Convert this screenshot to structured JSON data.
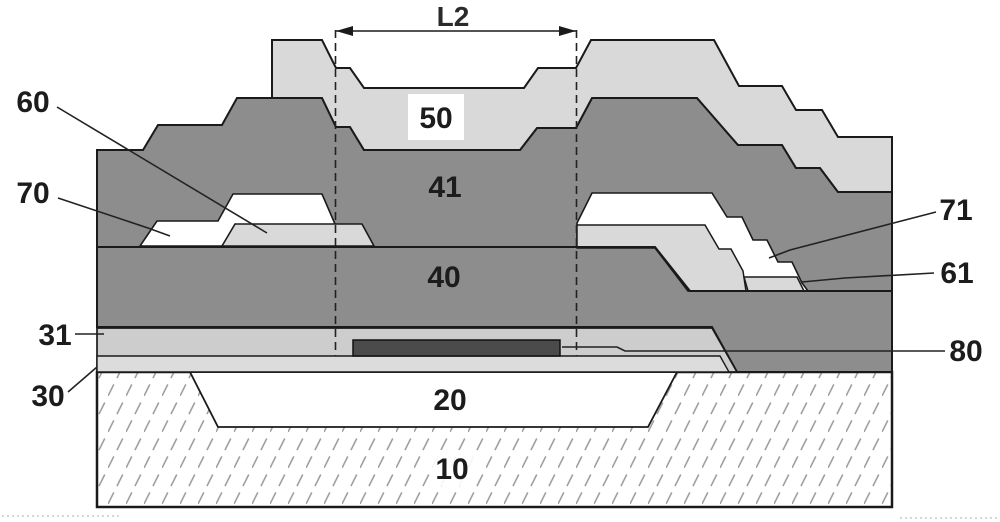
{
  "figure": {
    "type": "patent cross-section diagram of layered thin-film device",
    "dimension": {
      "label": "L2"
    },
    "labels": {
      "l2": {
        "text": "L2"
      },
      "n10": {
        "text": "10"
      },
      "n20": {
        "text": "20"
      },
      "n30": {
        "text": "30"
      },
      "n31": {
        "text": "31"
      },
      "n40": {
        "text": "40"
      },
      "n41": {
        "text": "41"
      },
      "n50": {
        "text": "50"
      },
      "n60": {
        "text": "60"
      },
      "n61": {
        "text": "61"
      },
      "n70": {
        "text": "70"
      },
      "n71": {
        "text": "71"
      },
      "n80": {
        "text": "80"
      }
    },
    "colors": {
      "background": "#ffffff",
      "layer_dark_gray": "#8d8d8d",
      "layer_light_gray": "#d9d9d9",
      "layer_31_gray": "#cdcdcd",
      "layer_30_gray": "#dcdcdc",
      "bar_dark": "#4b4b4b",
      "outline": "#1a1a1a",
      "hatch_line": "#a0a0a0",
      "label_text": "#1c1c1c"
    }
  }
}
